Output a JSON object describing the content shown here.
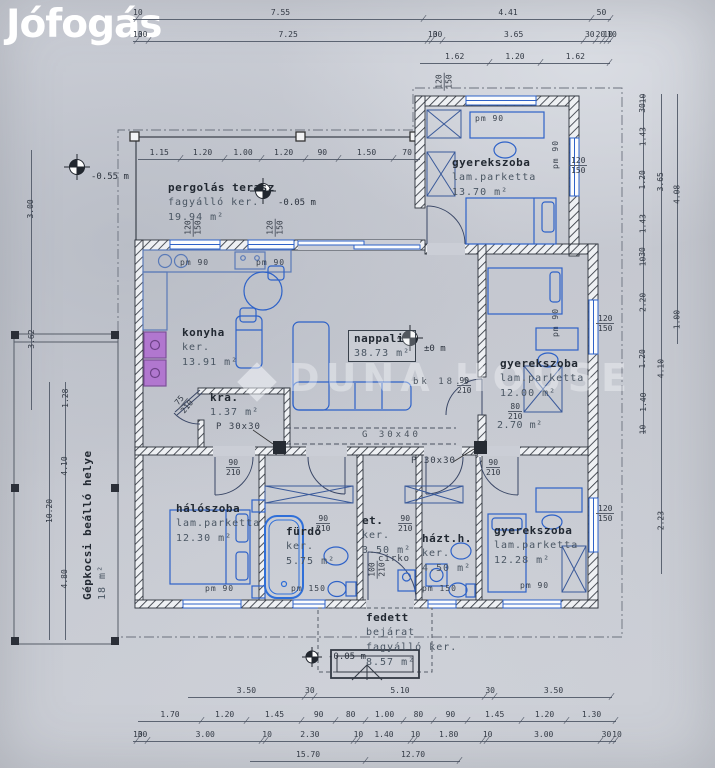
{
  "watermark": {
    "brand": "Jófogás",
    "agency": "DUNA HOUSE"
  },
  "rooms": [
    {
      "id": "pergolas-terasz",
      "lines": [
        "pergolás terasz",
        "fagyálló ker.",
        "19.94 m²"
      ]
    },
    {
      "id": "gyerekszoba-1",
      "lines": [
        "gyerekszoba",
        "lam.parketta",
        "13.70 m²"
      ]
    },
    {
      "id": "konyha",
      "lines": [
        "konyha",
        "ker.",
        "13.91 m²"
      ]
    },
    {
      "id": "nappali",
      "lines": [
        "nappali",
        "38.73 m²"
      ]
    },
    {
      "id": "kamra",
      "lines": [
        "kra.",
        "1.37 m²"
      ]
    },
    {
      "id": "gyerekszoba-2",
      "lines": [
        "gyerekszoba",
        "lam.parketta",
        "12.00 m²"
      ]
    },
    {
      "id": "wc",
      "lines": [
        "2.70 m²"
      ]
    },
    {
      "id": "haloszoba",
      "lines": [
        "hálószoba",
        "lam.parketta",
        "12.30 m²"
      ]
    },
    {
      "id": "furdo",
      "lines": [
        "fürdő",
        "ker.",
        "5.75 m²"
      ]
    },
    {
      "id": "eloter",
      "lines": [
        "et.",
        "ker.",
        "3.50 m²"
      ]
    },
    {
      "id": "haztartasi",
      "lines": [
        "házt.h.",
        "ker.",
        "4.50 m²"
      ]
    },
    {
      "id": "gyerekszoba-3",
      "lines": [
        "gyerekszoba",
        "lam.parketta",
        "12.28 m²"
      ]
    },
    {
      "id": "fedett-bejarat",
      "lines": [
        "fedett",
        "bejárat",
        "fagyálló ker.",
        "8.57 m²"
      ]
    },
    {
      "id": "carport",
      "lines": [
        "Gépkocsi beálló helye",
        "18 m²"
      ]
    }
  ],
  "extra": {
    "cirko": "cirko"
  },
  "levels": [
    "-0.55 m",
    "-0.05 m",
    "±0 m",
    "-0.05 m"
  ],
  "beams": [
    "P 30x30",
    "G 30x40",
    "P 30x30",
    "bk 18.5"
  ],
  "pm_labels": [
    "pm 90",
    "pm 90",
    "pm 90",
    "pm 90",
    "pm 90",
    "pm 90",
    "pm 90",
    "pm 150",
    "pm 150"
  ],
  "window_labels": [
    {
      "w": "120",
      "h": "150"
    },
    {
      "w": "120",
      "h": "150"
    },
    {
      "w": "120",
      "h": "150"
    },
    {
      "w": "120",
      "h": "150"
    },
    {
      "w": "120",
      "h": "150"
    },
    {
      "w": "120",
      "h": "150"
    }
  ],
  "door_labels": [
    {
      "w": "75",
      "h": "210"
    },
    {
      "w": "90",
      "h": "210"
    },
    {
      "w": "90",
      "h": "210"
    },
    {
      "w": "90",
      "h": "210"
    },
    {
      "w": "90",
      "h": "210"
    },
    {
      "w": "90",
      "h": "210"
    },
    {
      "w": "80",
      "h": "210"
    },
    {
      "w": "100",
      "h": "210"
    }
  ],
  "dims": {
    "top1": [
      "10",
      "7.55",
      "4.41",
      "50"
    ],
    "top2": [
      "10",
      "30",
      "7.25",
      "10",
      "30",
      "3.65",
      "30",
      "20",
      "10",
      "10"
    ],
    "top3": [
      "1.62",
      "1.20",
      "1.62"
    ],
    "terrace": [
      "1.15",
      "1.20",
      "1.00",
      "1.20",
      "90",
      "1.50",
      "70"
    ],
    "bottom1": [
      "3.50",
      "30",
      "5.10",
      "30",
      "3.50"
    ],
    "bottom2": [
      "1.70",
      "1.20",
      "1.45",
      "90",
      "80",
      "1.00",
      "80",
      "90",
      "1.45",
      "1.20",
      "1.30"
    ],
    "bottom3": [
      "10",
      "30",
      "3.00",
      "10",
      "2.30",
      "10",
      "1.40",
      "10",
      "1.80",
      "10",
      "3.00",
      "30",
      "10"
    ],
    "bottom4": [
      "15.70",
      "12.70"
    ],
    "leftA": [
      "3.00",
      "3.62"
    ],
    "leftB": [
      "10.20"
    ],
    "leftC": [
      "1.28",
      "4.10",
      "4.80"
    ],
    "rightA": [
      "10",
      "30",
      "1.43",
      "1.20",
      "1.43",
      "30",
      "10",
      "2.20",
      "1.20",
      "1.40",
      "10"
    ],
    "rightB": [
      "3.65",
      "4.10",
      "2.23"
    ],
    "rightC": [
      "4.08",
      "1.00"
    ]
  },
  "colors": {
    "furniture": "#2e62c8",
    "walls": "#2c313a",
    "paper": "#cbced6",
    "appliance": "#b177cf",
    "watermark": "#ffffff"
  }
}
